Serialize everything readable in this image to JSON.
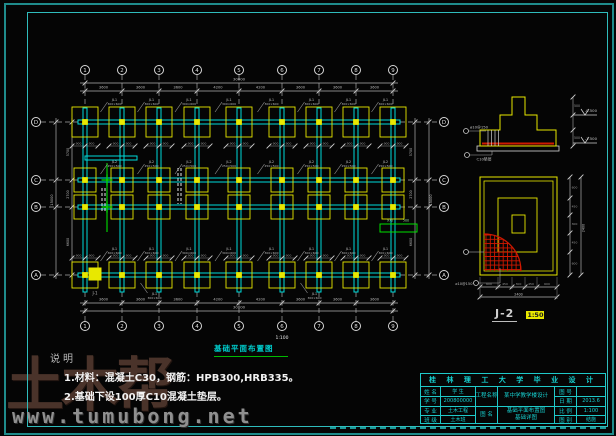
{
  "colors": {
    "cyan": "#00dcdc",
    "yellow": "#e8e800",
    "green": "#00e000",
    "red": "#d01800",
    "gray": "#a8a8a8",
    "white": "#efefef",
    "dim": "#b0b0b0",
    "tick": "#d0d0d0"
  },
  "watermark": {
    "big": "土木帮",
    "url": "www.tumubong.net"
  },
  "plan": {
    "title": "基础平面布置图",
    "scale": "1:100",
    "axes_x": {
      "labels": [
        "1",
        "2",
        "3",
        "4",
        "5",
        "6",
        "7",
        "8",
        "9"
      ],
      "pos": [
        85,
        122,
        159,
        197,
        239,
        282,
        319,
        356,
        393
      ],
      "spans": [
        "3600",
        "3600",
        "3600",
        "4200",
        "4200",
        "3600",
        "3600",
        "3600"
      ],
      "total": "30000"
    },
    "axes_y": {
      "labels": [
        "D",
        "C",
        "B",
        "A"
      ],
      "pos": [
        122,
        180,
        207,
        275
      ],
      "spans": [
        "5700",
        "2700",
        "6600"
      ],
      "total": "15000"
    },
    "footing_dim": "900",
    "stair_dim": "970",
    "footing_tag": "J-1",
    "beam_labels": {
      "top": {
        "name": "JL1",
        "size": "300×600"
      },
      "mid": {
        "name": "JL2",
        "size": "250×500"
      },
      "bottom": {
        "name": "JL1",
        "size": "300×600"
      }
    }
  },
  "section": {
    "callout_rebar": "⌀10@150",
    "callout_bed": "C10垫层",
    "elev_top": "-0.500",
    "elev_bottom": "-1.500",
    "dims": [
      "500",
      "500"
    ]
  },
  "detail": {
    "label": "J-2",
    "scale": "1:50",
    "callout": "⌀10@150",
    "dims_v": [
      "600",
      "450",
      "300",
      "450",
      "600"
    ],
    "dims_h": [
      "600",
      "450",
      "300",
      "450",
      "600"
    ],
    "total_v": "2400",
    "total_h": "2400"
  },
  "notes": {
    "title": "说明",
    "items": [
      "1.材料：混凝土C30，钢筋：HPB300,HRB335。",
      "2.基础下设100厚C10混凝土垫层。"
    ]
  },
  "titleblock": {
    "header": "桂 林 理 工 大 学 毕 业 设 计",
    "left": [
      [
        "姓 名",
        "学 生"
      ],
      [
        "学 号",
        "200800000"
      ],
      [
        "专 业",
        "土木工程"
      ],
      [
        "班 级",
        "土木班"
      ]
    ],
    "project_label": "工程名称",
    "project": "某中学教学楼设计",
    "drawing_label": "图 名",
    "drawing": [
      "基础平面布置图",
      "基础详图"
    ],
    "right": [
      [
        "图 号",
        ""
      ],
      [
        "日 期",
        "2013.6"
      ],
      [
        "比 例",
        "1:100"
      ],
      [
        "图 别",
        "结施"
      ]
    ]
  }
}
